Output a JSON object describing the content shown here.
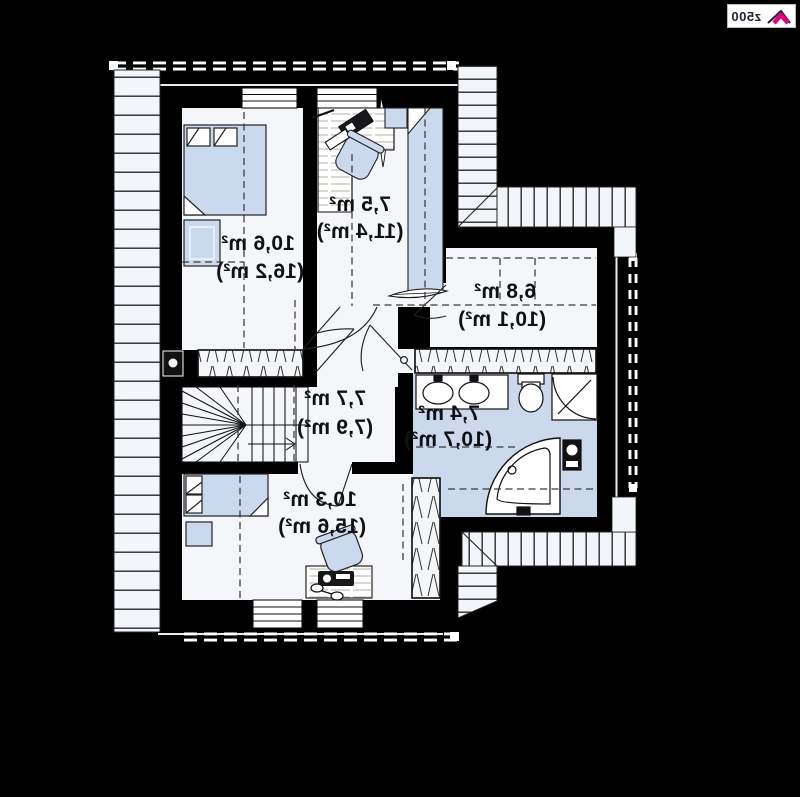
{
  "logo": {
    "text": "z500"
  },
  "plan": {
    "rooms": [
      {
        "name": "bedroom-upper-left",
        "area": "10,6 m²",
        "area_gross": "(16,2 m²)"
      },
      {
        "name": "room-upper-middle",
        "area": "7,5 m²",
        "area_gross": "(11,4 m²)"
      },
      {
        "name": "room-right",
        "area": "6,8 m²",
        "area_gross": "(10,1 m²)"
      },
      {
        "name": "hall-stairs",
        "area": "7,7 m²",
        "area_gross": "(7,9 m²)"
      },
      {
        "name": "bathroom",
        "area": "7,4 m²",
        "area_gross": "(10,7 m²)"
      },
      {
        "name": "bedroom-lower-left",
        "area": "10,3 m²",
        "area_gross": "(15,6 m²)"
      }
    ],
    "colors": {
      "background": "#000000",
      "floor": "#f4f6fa",
      "furniture": "#cbd9ee",
      "bathroom_floor": "#ccd8ec",
      "logo_accent": "#e5007d"
    }
  }
}
